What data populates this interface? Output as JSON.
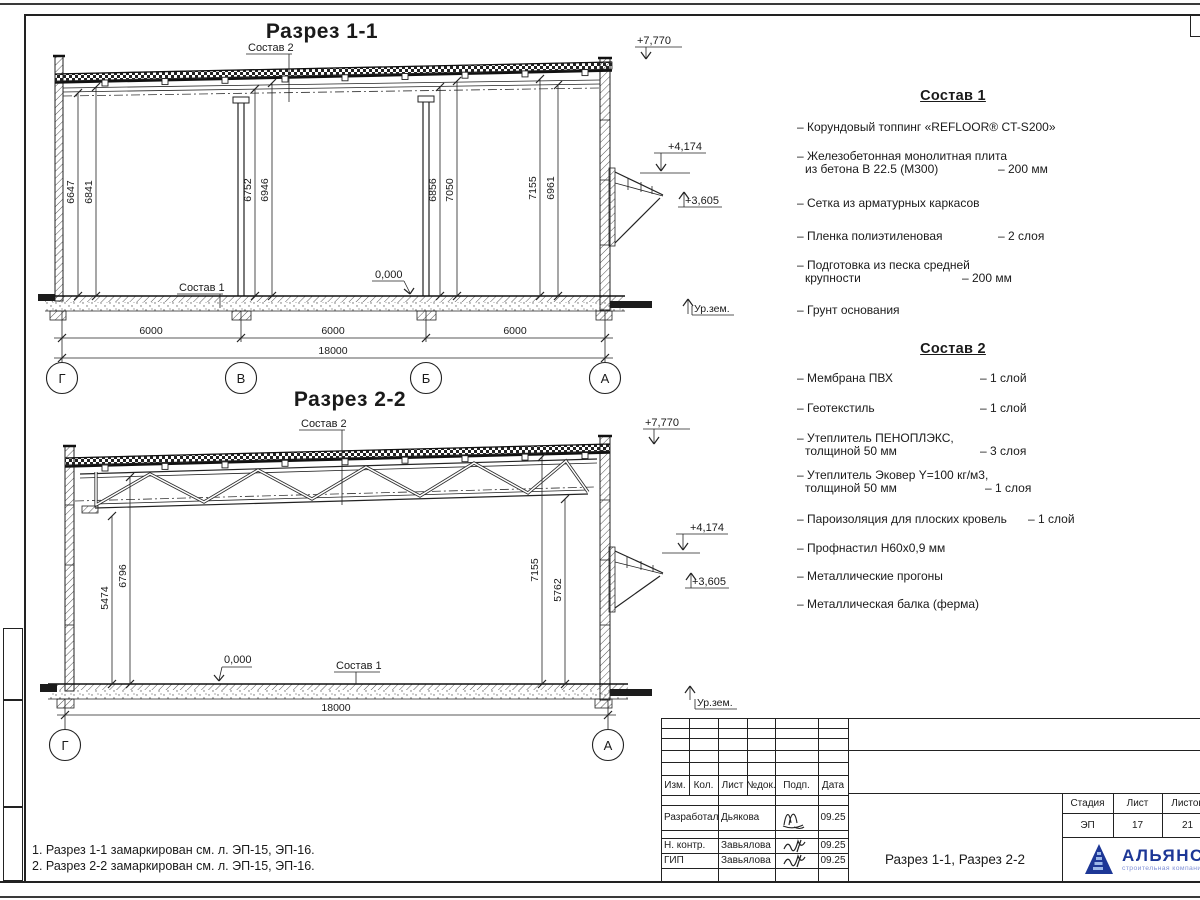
{
  "notes": {
    "line1": "1. Разрез 1-1 замаркирован см. л. ЭП-15, ЭП-16.",
    "line2": "2. Разрез 2-2 замаркирован см. л. ЭП-15, ЭП-16."
  },
  "section1": {
    "title": "Разрез 1-1",
    "sostav1_label": "Состав 1",
    "sostav2_label": "Состав 2",
    "ground_label": "Ур.зем.",
    "elev_top": "+7,770",
    "elev_canopy_top": "+4,174",
    "elev_canopy_bottom": "+3,605",
    "elev_zero": "0,000",
    "dims": [
      "6647",
      "6841",
      "6752",
      "6946",
      "6856",
      "7050",
      "7155",
      "6961"
    ],
    "spans": [
      "6000",
      "6000",
      "6000"
    ],
    "total": "18000",
    "axes": [
      "Г",
      "В",
      "Б",
      "А"
    ]
  },
  "section2": {
    "title": "Разрез 2-2",
    "sostav1_label": "Состав 1",
    "sostav2_label": "Состав 2",
    "ground_label": "Ур.зем.",
    "elev_top": "+7,770",
    "elev_canopy_top": "+4,174",
    "elev_canopy_bottom": "+3,605",
    "elev_zero": "0,000",
    "dims": [
      "5474",
      "6796",
      "7155",
      "5762"
    ],
    "total": "18000",
    "axes": [
      "Г",
      "А"
    ]
  },
  "sostav1": {
    "title": "Состав 1",
    "items": [
      {
        "l1": "– Корундовый топпинг «REFLOOR® CT-S200»"
      },
      {
        "l1": "– Железобетонная  монолитная плита",
        "l2": "из бетона В 22.5 (М300)",
        "v2": "– 200 мм"
      },
      {
        "l1": "– Сетка из арматурных каркасов"
      },
      {
        "l1": "– Пленка полиэтиленовая",
        "v1": "– 2 слоя"
      },
      {
        "l1": "– Подготовка из песка средней",
        "l2": "крупности",
        "v2": "– 200 мм"
      },
      {
        "l1": "– Грунт основания"
      }
    ]
  },
  "sostav2": {
    "title": "Состав 2",
    "items": [
      {
        "l1": "– Мембрана ПВХ",
        "v1": "– 1 слой"
      },
      {
        "l1": "– Геотекстиль",
        "v1": "– 1 слой"
      },
      {
        "l1": "– Утеплитель ПЕНОПЛЭКС,",
        "l2": "толщиной 50 мм",
        "v2": "– 3 слоя"
      },
      {
        "l1": "– Утеплитель Эковер Y=100 кг/м3,",
        "l2": "толщиной 50 мм",
        "v2": "– 1 слоя"
      },
      {
        "l1": "– Пароизоляция для плоских кровель",
        "v1": "– 1 слой"
      },
      {
        "l1": "– Профнастил Н60х0,9 мм"
      },
      {
        "l1": "– Металлические прогоны"
      },
      {
        "l1": "– Металлическая балка (ферма)"
      }
    ]
  },
  "titleblock": {
    "headers": [
      "Изм.",
      "Кол.",
      "Лист",
      "№док.",
      "Подп.",
      "Дата"
    ],
    "rows": [
      {
        "role": "Разработал",
        "name": "Дьякова",
        "date": "09.25"
      },
      {
        "role": "Н. контр.",
        "name": "Завьялова",
        "date": "09.25"
      },
      {
        "role": "ГИП",
        "name": "Завьялова",
        "date": "09.25"
      }
    ],
    "doc_title": "Разрез 1-1, Разрез 2-2",
    "stage_label": "Стадия",
    "sheet_label": "Лист",
    "sheets_label": "Листов",
    "stage": "ЭП",
    "sheet_no": "17",
    "sheets_total": "21",
    "logo_name": "АЛЬЯНС",
    "logo_subtitle": "строительная компания",
    "logo_color": "#1d3796",
    "logo_accent": "#8292d6"
  }
}
